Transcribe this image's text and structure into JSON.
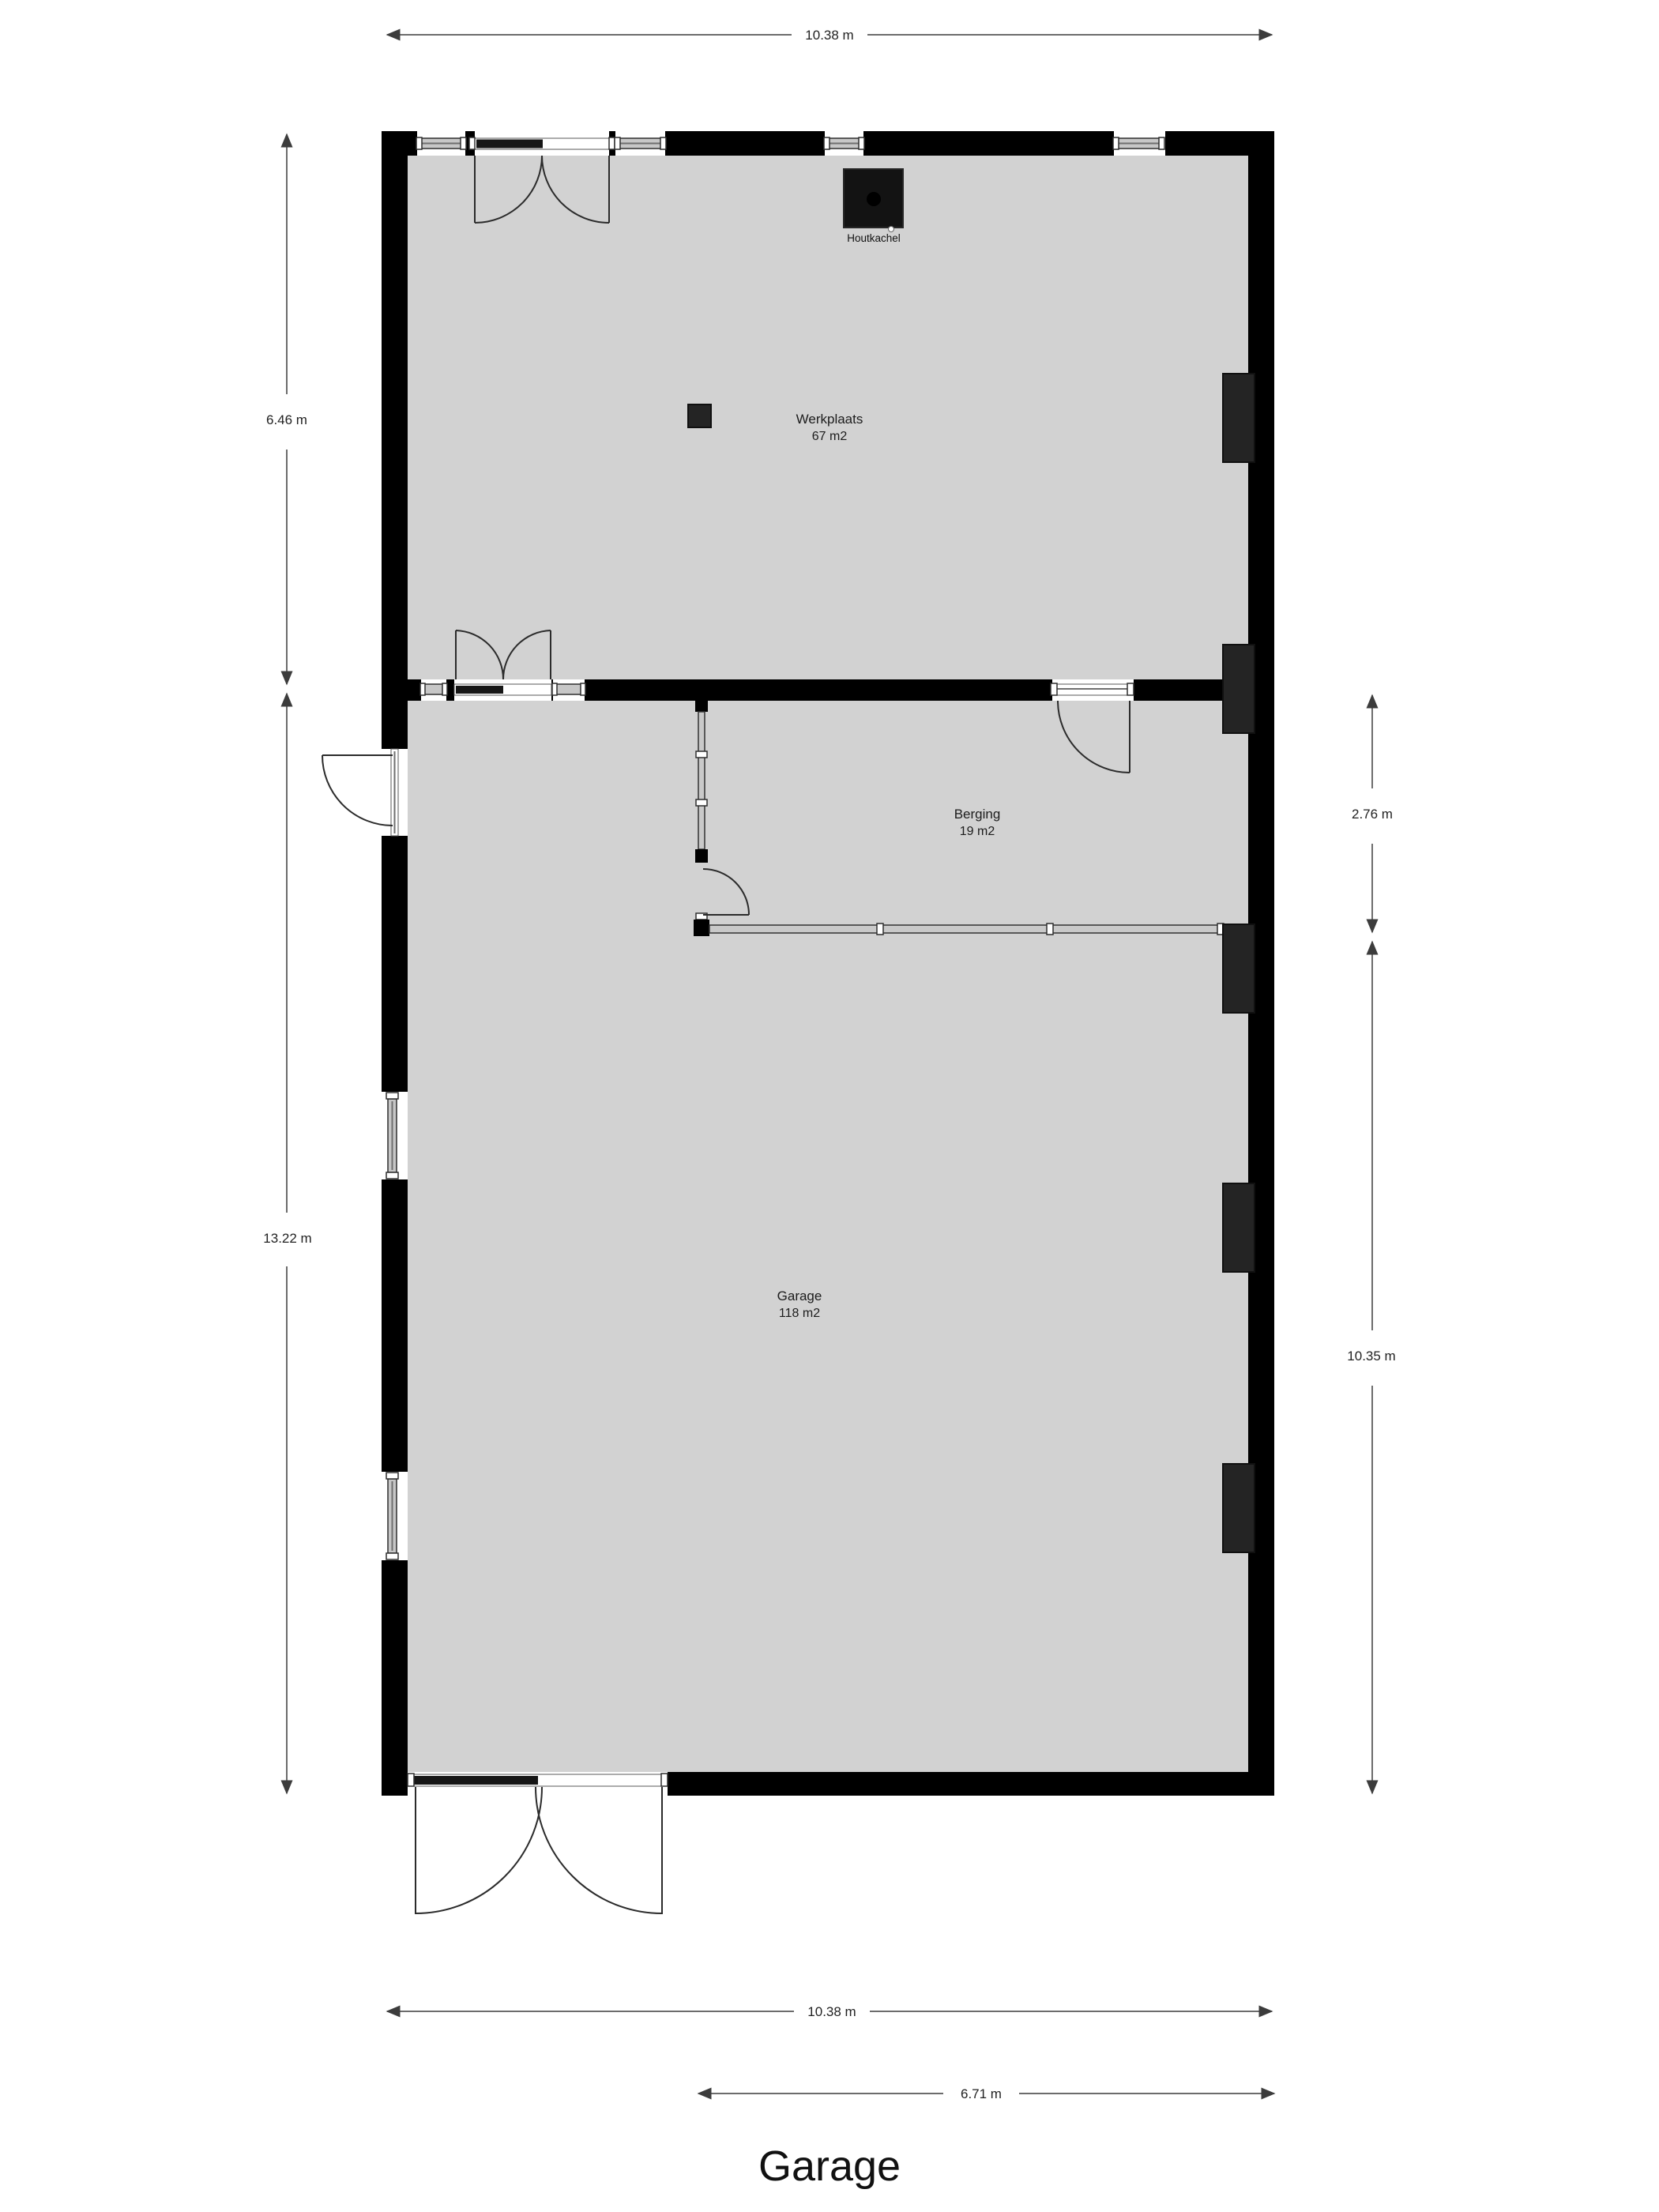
{
  "title": "Garage",
  "rooms": [
    {
      "name": "Werkplaats",
      "area": "67 m2"
    },
    {
      "name": "Berging",
      "area": "19 m2"
    },
    {
      "name": "Garage",
      "area": "118 m2"
    }
  ],
  "fixtures": {
    "stove": "Houtkachel"
  },
  "dimensions": {
    "top_width": "10.38 m",
    "left_upper": "6.46 m",
    "left_lower": "13.22 m",
    "right_upper": "2.76 m",
    "right_lower": "10.35 m",
    "bottom_width": "10.38 m",
    "bottom_partial": "6.71 m"
  },
  "colors": {
    "background": "#ffffff",
    "wall": "#000000",
    "floor": "#d2d2d2",
    "column": "#242424",
    "stove": "#131313"
  }
}
